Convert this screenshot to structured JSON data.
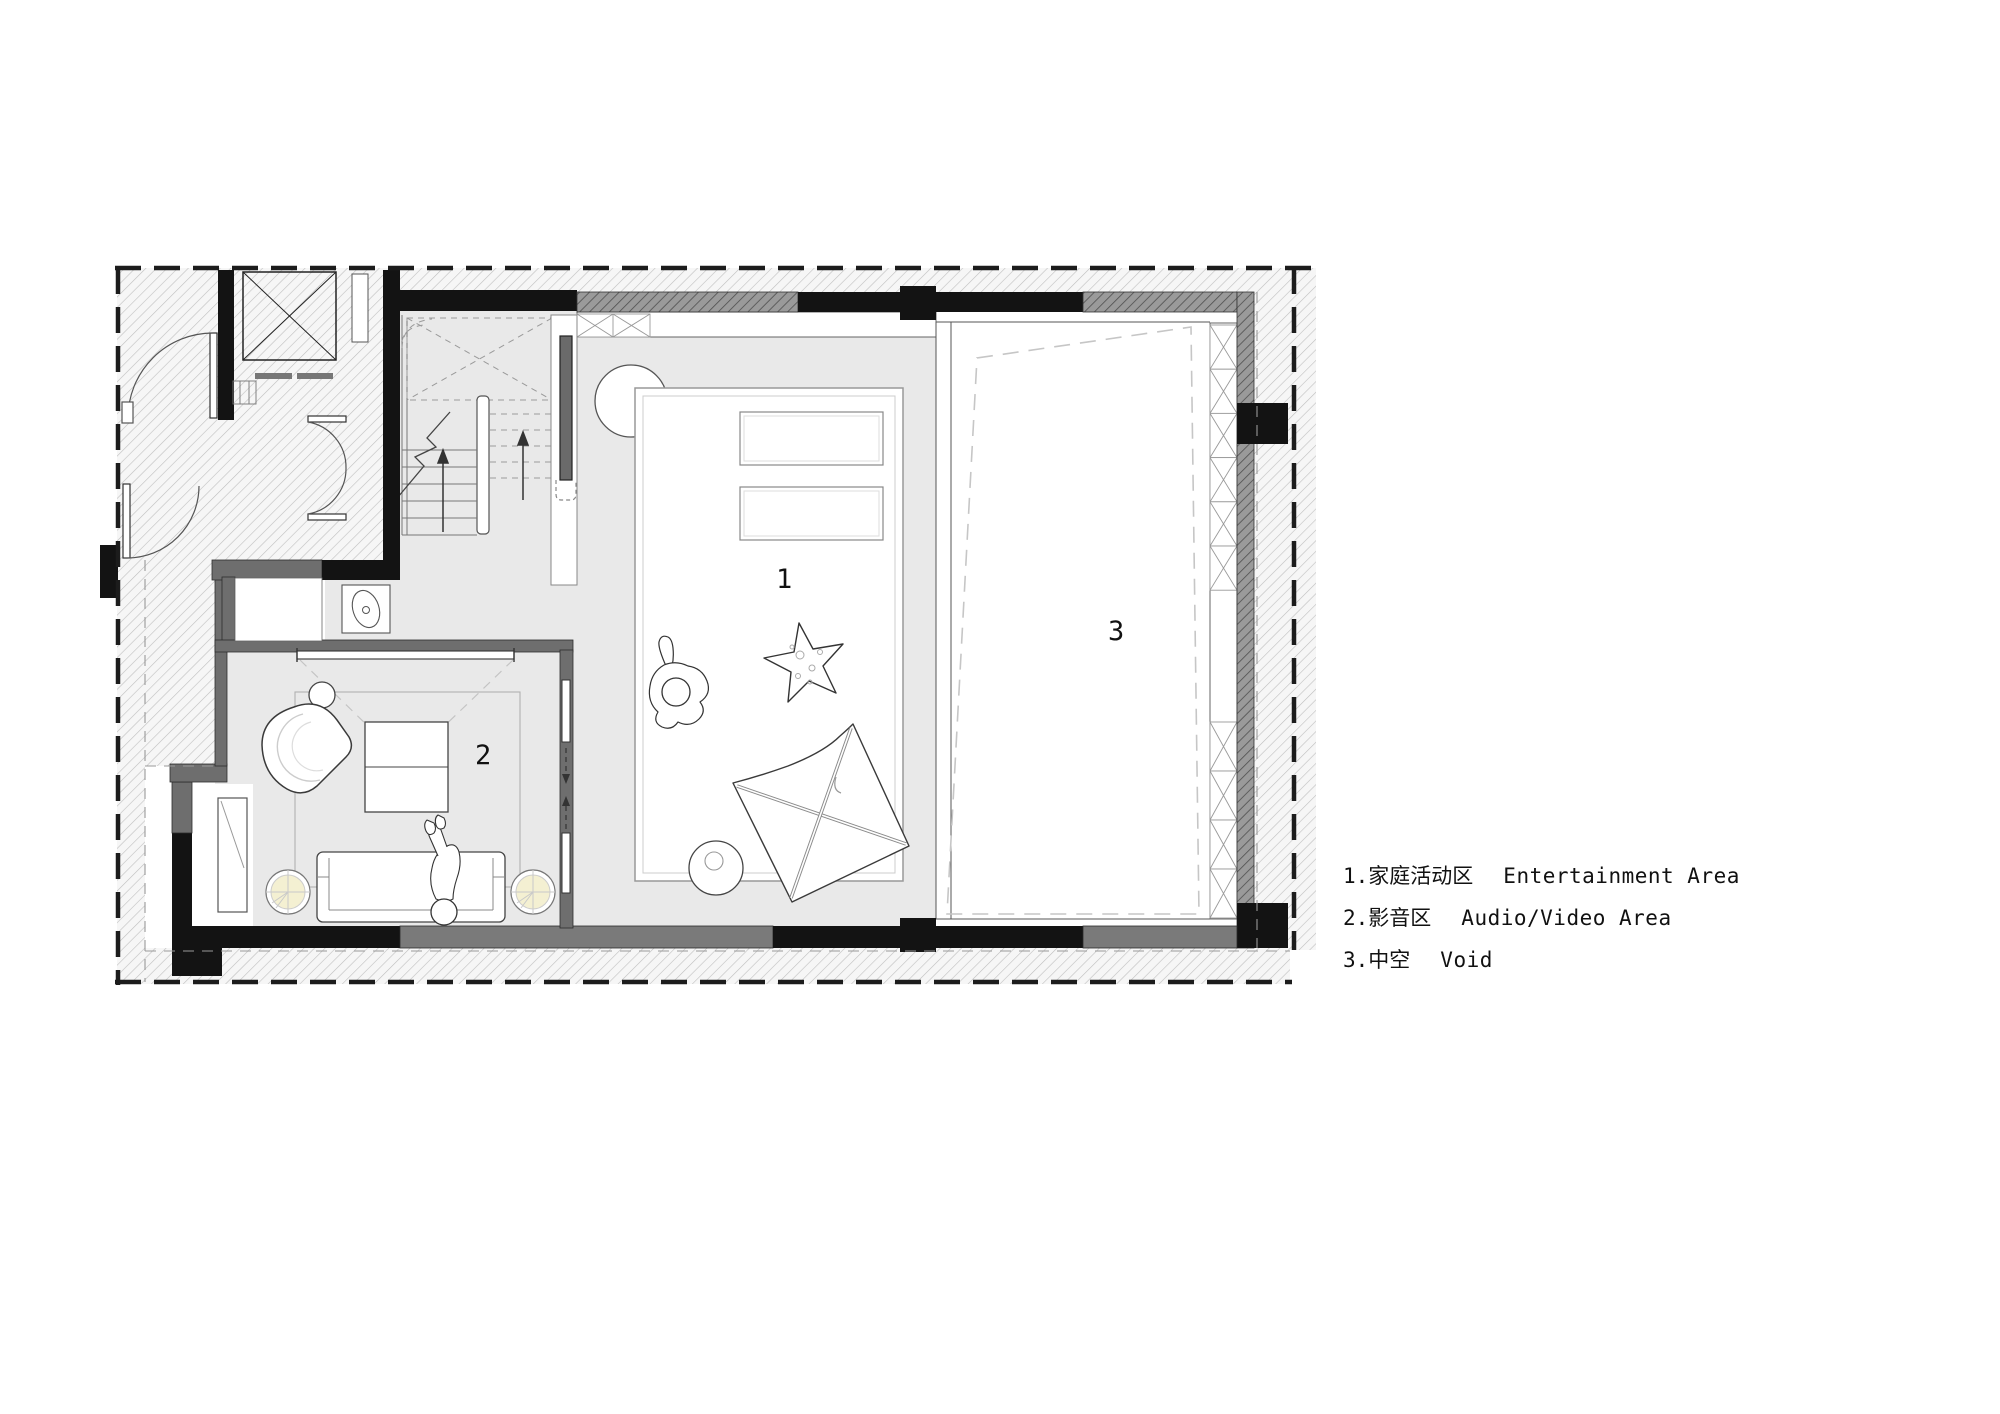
{
  "legend": {
    "items": [
      {
        "label_zh": "1.家庭活动区",
        "label_en": "Entertainment Area"
      },
      {
        "label_zh": "2.影音区",
        "label_en": "Audio/Video Area"
      },
      {
        "label_zh": "3.中空",
        "label_en": "Void"
      }
    ]
  },
  "plan": {
    "rooms": [
      {
        "number": "1",
        "name_en": "Entertainment Area"
      },
      {
        "number": "2",
        "name_en": "Audio/Video Area"
      },
      {
        "number": "3",
        "name_en": "Void"
      }
    ]
  },
  "colors": {
    "floor": "#e9e9e9",
    "wall_dark": "#6e6e6e",
    "wall_black": "#131313",
    "wall_gray": "#7a7a7a",
    "lamp_glow": "#f4f0d2",
    "hatch_line": "#bfbfbf",
    "dashed_boundary": "#1c1c1c"
  }
}
